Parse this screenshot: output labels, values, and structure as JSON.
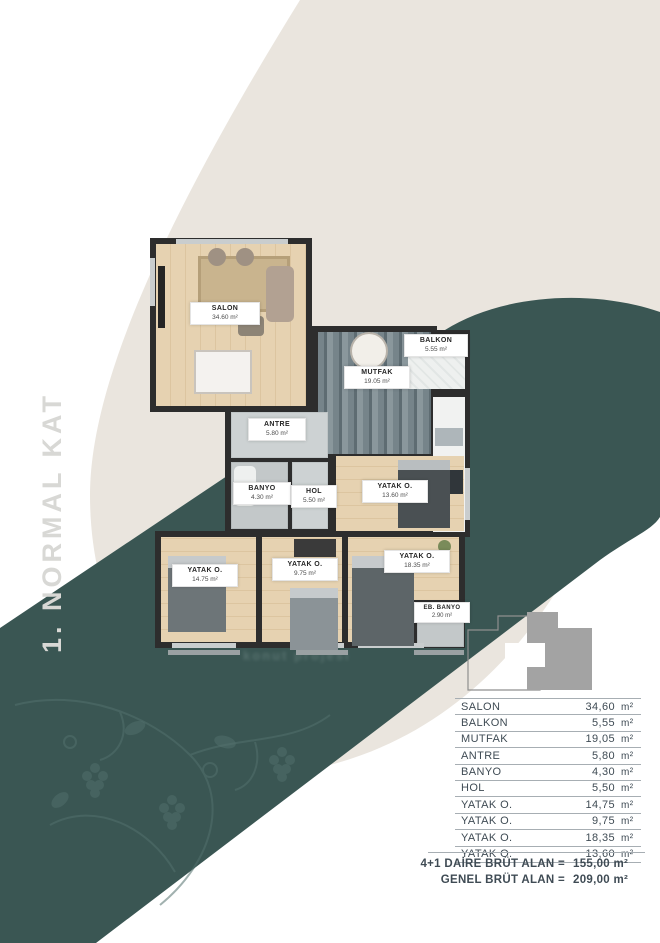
{
  "page_title": "1. NORMAL KAT",
  "watermark": "konut projesi",
  "colors": {
    "teal": "#3a5653",
    "beige": "#eae5de",
    "wall": "#2d2d2d",
    "table_text": "#3f4b54",
    "keyplan_gray": "#a3a3a3"
  },
  "floorplan": {
    "rooms": [
      {
        "id": "salon",
        "label": "SALON",
        "area": "34.60 m²"
      },
      {
        "id": "mutfak",
        "label": "MUTFAK",
        "area": "19.05 m²"
      },
      {
        "id": "balkon",
        "label": "BALKON",
        "area": "5.55 m²"
      },
      {
        "id": "antre",
        "label": "ANTRE",
        "area": "5.80 m²"
      },
      {
        "id": "banyo",
        "label": "BANYO",
        "area": "4.30 m²"
      },
      {
        "id": "hol",
        "label": "HOL",
        "area": "5.50 m²"
      },
      {
        "id": "yatak13",
        "label": "YATAK O.",
        "area": "13.60 m²"
      },
      {
        "id": "yatak14",
        "label": "YATAK O.",
        "area": "14.75 m²"
      },
      {
        "id": "yatak9",
        "label": "YATAK O.",
        "area": "9.75 m²"
      },
      {
        "id": "yatak18",
        "label": "YATAK O.",
        "area": "18.35 m²"
      },
      {
        "id": "ebbanyo",
        "label": "EB. BANYO",
        "area": "2.90 m²"
      }
    ]
  },
  "table": {
    "rows": [
      {
        "name": "SALON",
        "value": "34,60",
        "unit": "m²"
      },
      {
        "name": "BALKON",
        "value": "5,55",
        "unit": "m²"
      },
      {
        "name": "MUTFAK",
        "value": "19,05",
        "unit": "m²"
      },
      {
        "name": "ANTRE",
        "value": "5,80",
        "unit": "m²"
      },
      {
        "name": "BANYO",
        "value": "4,30",
        "unit": "m²"
      },
      {
        "name": "HOL",
        "value": "5,50",
        "unit": "m²"
      },
      {
        "name": "YATAK O.",
        "value": "14,75",
        "unit": "m²"
      },
      {
        "name": "YATAK O.",
        "value": "9,75",
        "unit": "m²"
      },
      {
        "name": "YATAK O.",
        "value": "18,35",
        "unit": "m²"
      },
      {
        "name": "YATAK O.",
        "value": "13,60",
        "unit": "m²"
      }
    ]
  },
  "totals": [
    {
      "label": "4+1 DAİRE BRÜT ALAN =",
      "value": "155,00 m²"
    },
    {
      "label": "GENEL BRÜT ALAN =",
      "value": "209,00 m²"
    }
  ]
}
